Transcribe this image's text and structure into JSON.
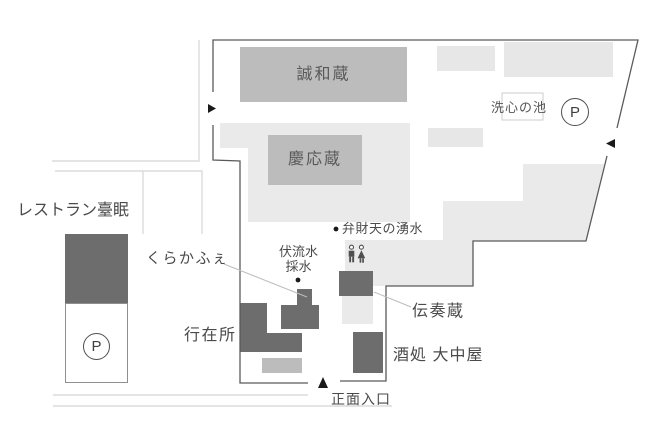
{
  "map": {
    "buildings": {
      "seiwakura": {
        "label": "誠和蔵"
      },
      "keiokura": {
        "label": "慶応蔵"
      },
      "restaurant": {
        "label": "レストラン臺眠"
      },
      "kuracafe": {
        "label": "くらかふぇ"
      },
      "anzaisho": {
        "label": "行在所"
      },
      "densokura": {
        "label": "伝奏蔵"
      },
      "sakedokoro": {
        "label": "酒処 大中屋"
      }
    },
    "places": {
      "pond": {
        "label": "洗心の池"
      },
      "benzaiten_spring": {
        "label": "弁財天の湧水"
      },
      "spring_water_tap": {
        "line1": "伏流水",
        "line2": "採水"
      },
      "main_entrance": {
        "label": "正面入口"
      }
    },
    "parking_label": "P",
    "icons": {
      "restroom": "male-female-figures",
      "entrance_arrow_up": "▲",
      "entrance_arrow_right": "▶",
      "entrance_arrow_left": "◀",
      "spring_dot": "●"
    },
    "colors": {
      "building_dark": "#6d6d6d",
      "building_medium": "#bcbcbc",
      "building_light": "#e7e7e7",
      "grounds": "#eaeaea",
      "boundary_line": "#5a5a5a",
      "road_line": "#dcdcdc",
      "pointer_line": "#bdbdbd",
      "text": "#4a4a4a",
      "marker": "#1a1a1a"
    }
  }
}
